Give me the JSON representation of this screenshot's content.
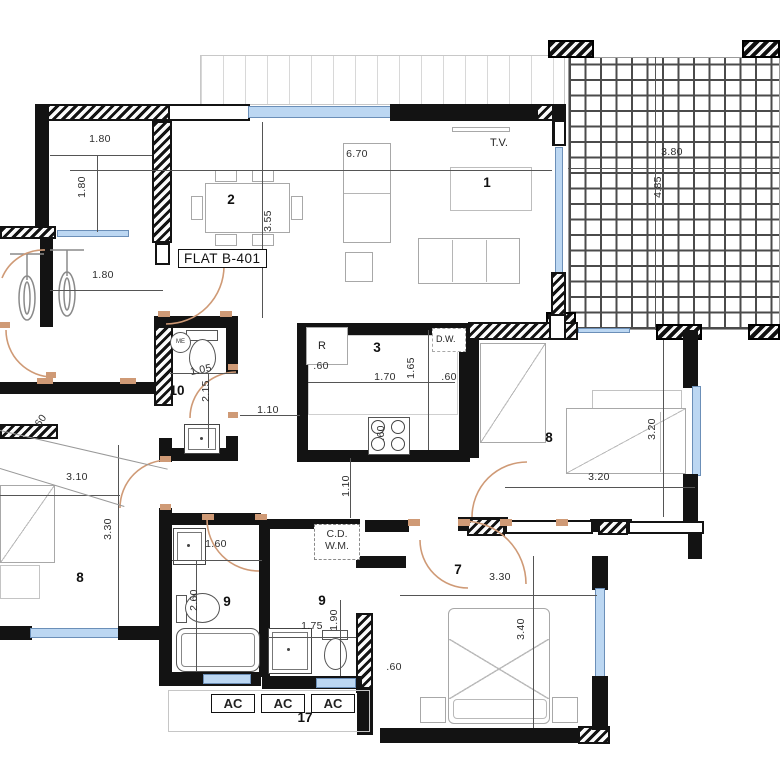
{
  "flat_label": "FLAT B-401",
  "rooms": {
    "living": "1",
    "dining": "2",
    "kitchen": "3",
    "hall7": "7",
    "bedroom_right": "8",
    "bedroom_left": "8",
    "bath_left": "9",
    "bath_mid": "9",
    "wc": "10",
    "service": "17"
  },
  "labels": {
    "tv": "T.V.",
    "fridge": "R",
    "dishwasher": "D.W.",
    "closet_line1": "C.D.",
    "closet_line2": "W.M.",
    "basin": "ME",
    "ac1": "AC",
    "ac2": "AC",
    "ac3": "AC"
  },
  "dims": [
    {
      "t": "1.80"
    },
    {
      "t": "1.80"
    },
    {
      "t": "1.80"
    },
    {
      "t": "6.70"
    },
    {
      "t": "3.55"
    },
    {
      "t": "3.80"
    },
    {
      "t": "4.85"
    },
    {
      "t": "1.05"
    },
    {
      "t": "2.15"
    },
    {
      "t": ".60"
    },
    {
      "t": "1.70"
    },
    {
      "t": "1.65"
    },
    {
      "t": ".60"
    },
    {
      "t": ".60"
    },
    {
      "t": "1.10"
    },
    {
      "t": "1.10"
    },
    {
      "t": ".60"
    },
    {
      "t": "3.10"
    },
    {
      "t": "3.30"
    },
    {
      "t": "3.20"
    },
    {
      "t": "3.20"
    },
    {
      "t": "1.60"
    },
    {
      "t": "2.60"
    },
    {
      "t": "1.75"
    },
    {
      "t": "1.90"
    },
    {
      "t": "3.30"
    },
    {
      "t": "3.40"
    },
    {
      "t": ".60"
    }
  ],
  "colors": {
    "wall": "#131313",
    "door": "#cf9a76",
    "window_fill": "#bcd7f2",
    "window_border": "#6b8fb8",
    "dim_text": "#2d2d2d",
    "furniture": "#a8a8a8"
  }
}
